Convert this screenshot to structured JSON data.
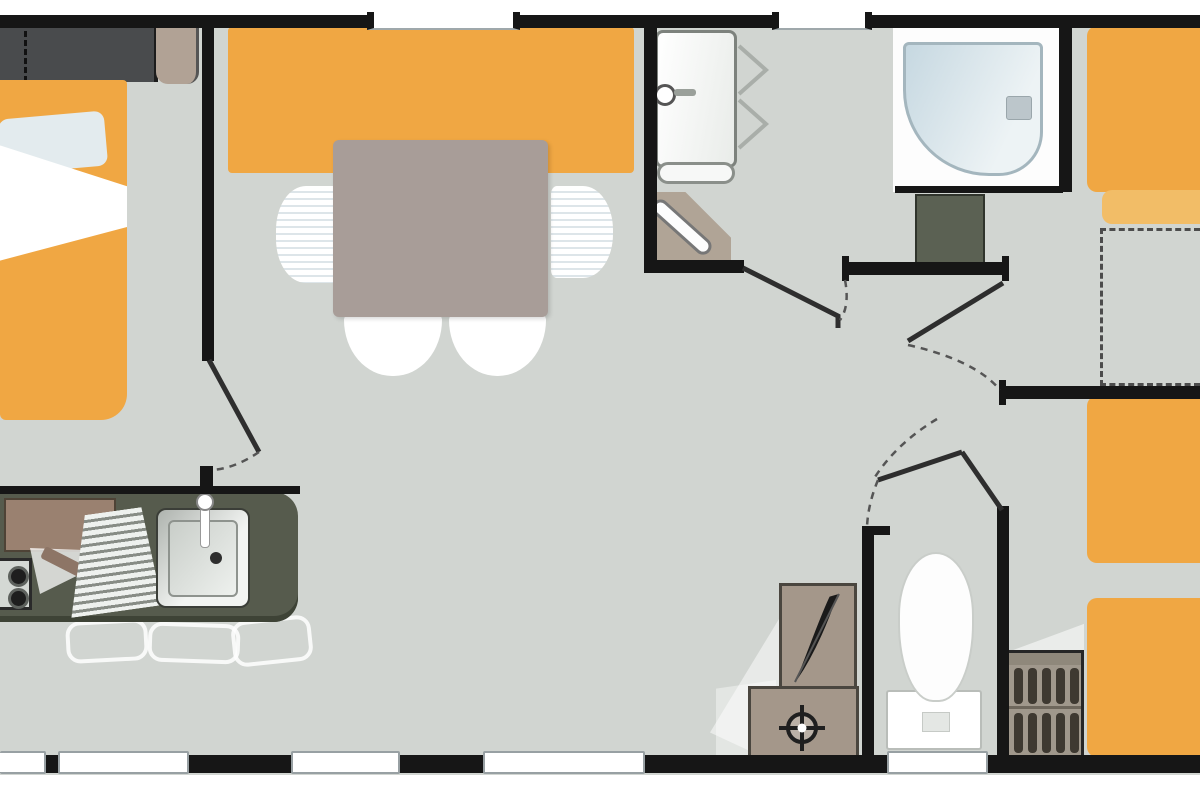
{
  "diagram": {
    "kind": "mobile-home-floor-plan",
    "orientation": "landscape",
    "visible_text": [],
    "rooms": [
      {
        "name": "master-bedroom-left",
        "furniture": [
          "double-bed",
          "pillow",
          "duvet",
          "wardrobe",
          "bedside-unit"
        ]
      },
      {
        "name": "living-dining-area",
        "furniture": [
          "bench-seat",
          "dining-table",
          "chair-left",
          "chair-right",
          "chair-bottom-1",
          "chair-bottom-2"
        ]
      },
      {
        "name": "kitchen",
        "furniture": [
          "worktop",
          "fridge-cabinet",
          "hob-two-burners",
          "draining-board",
          "sink",
          "faucet"
        ]
      },
      {
        "name": "shower-room",
        "furniture": [
          "water-heater",
          "towel-rail",
          "bifold-door",
          "shower-tray",
          "corner-cabinet",
          "washbasin-vanity"
        ]
      },
      {
        "name": "bedroom-top-right",
        "furniture": [
          "single-bed",
          "pillow",
          "optional-bed-dashed-area"
        ]
      },
      {
        "name": "twin-bedroom-right",
        "furniture": [
          "single-bed-1",
          "single-bed-2",
          "slatted-storage-unit"
        ]
      },
      {
        "name": "wc",
        "furniture": [
          "toilet",
          "utility-box-feather",
          "utility-box-crosshair"
        ]
      }
    ],
    "windows": {
      "top_wall": 2,
      "bottom_wall": 5
    },
    "doors": {
      "hinged": 5,
      "bifold": 1,
      "corner": 1
    }
  },
  "colors": {
    "floor": "#d1d5d1",
    "wall": "#161616",
    "orange": "#f0a743",
    "orangelight": "#f2bd67",
    "table": "#a89d98",
    "chairstripe": "#dde5e9",
    "counter": "#565b4d",
    "brown": "#9a8170",
    "tan": "#a4978a",
    "tanlight": "#b0a496",
    "wardrobe": "#494b4d",
    "vanity": "#5b6153",
    "shower1": "#c6d8e1",
    "shower2": "#edf3f5",
    "ladder": "#a0988c",
    "bar": "#3e3931"
  }
}
